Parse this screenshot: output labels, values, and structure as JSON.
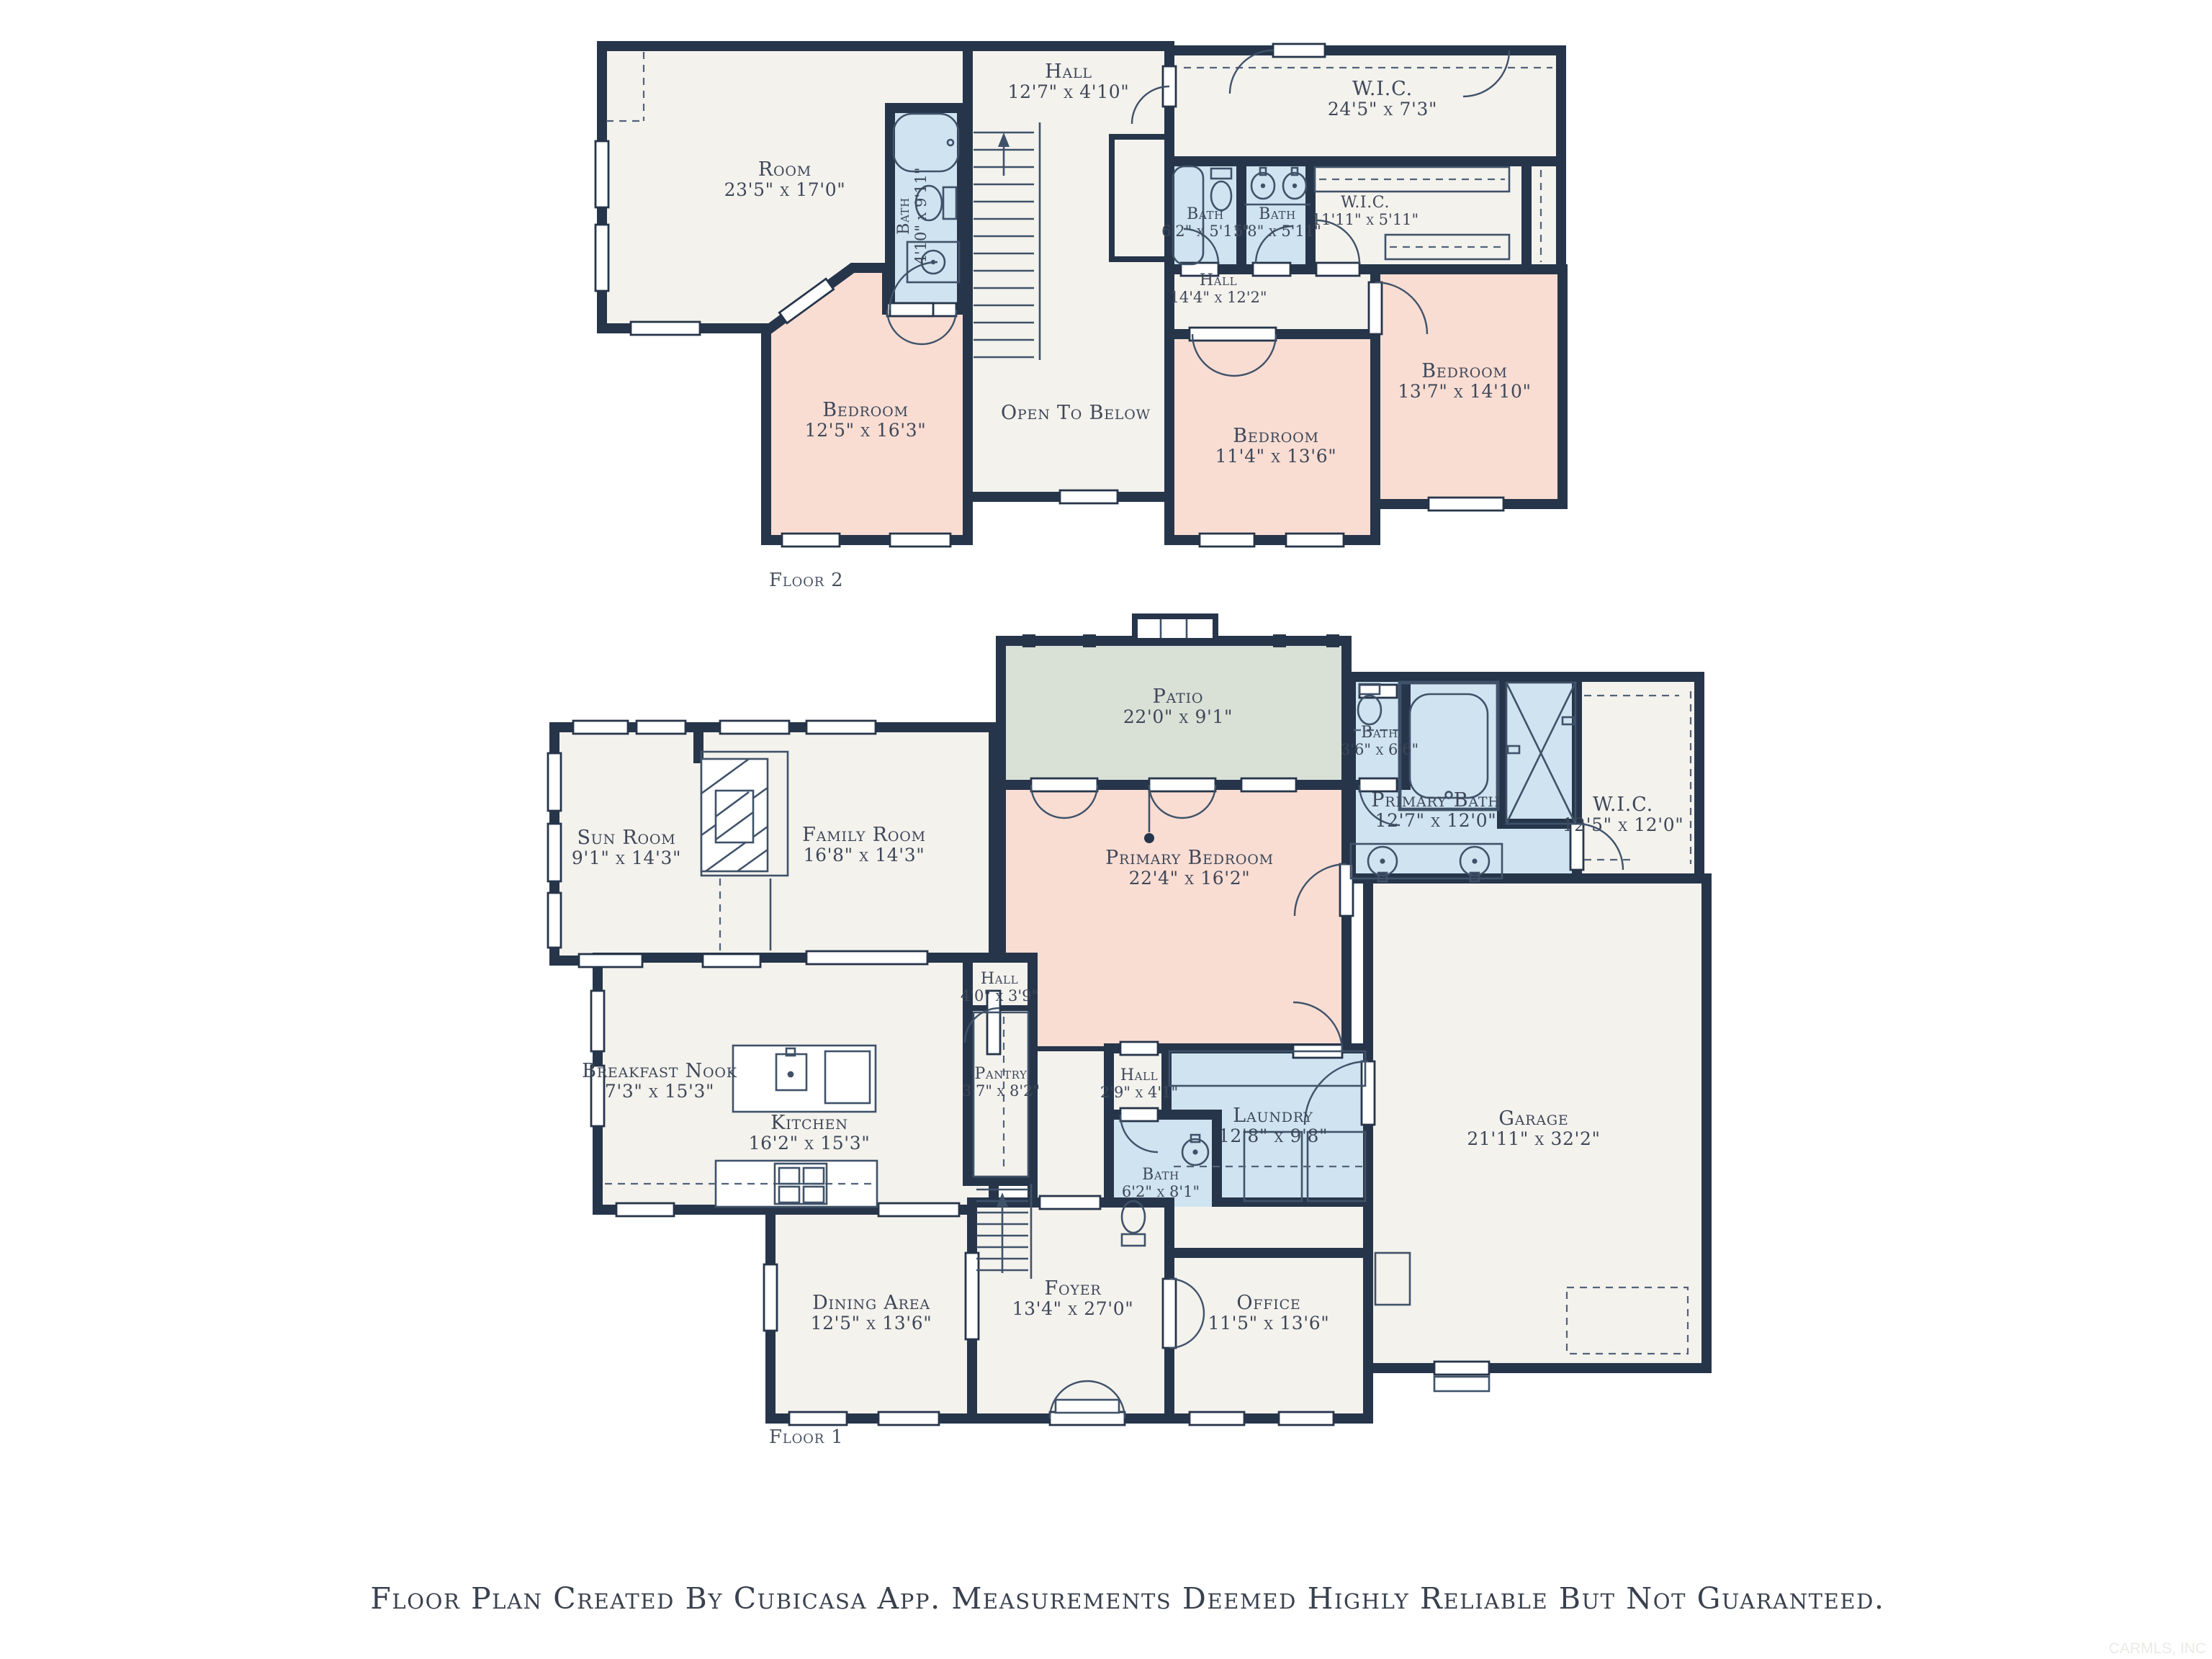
{
  "footer": "Floor Plan Created By Cubicasa App. Measurements Deemed Highly Reliable But Not Guaranteed.",
  "watermark": "CARMLS, INC",
  "colors": {
    "wall": "#26354a",
    "room_fill": "#f4f2ed",
    "bedroom_fill": "#f9ddd3",
    "bath_fill": "#cfe4f0",
    "patio_fill": "#d9e0d6",
    "label_text": "#3e4758",
    "background": "#ffffff"
  },
  "floor2": {
    "label": "Floor 2",
    "rooms": {
      "room": {
        "name": "Room",
        "dims": "23'5\" x 17'0\""
      },
      "hall_top": {
        "name": "Hall",
        "dims": "12'7\" x 4'10\""
      },
      "wic_large": {
        "name": "W.I.C.",
        "dims": "24'5\" x 7'3\""
      },
      "bath_stairs": {
        "name": "Bath",
        "dims": "4'10\" x 9'11\""
      },
      "bath_left": {
        "name": "Bath",
        "dims": "6'2\" x 5'11\""
      },
      "bath_right": {
        "name": "Bath",
        "dims": "5'8\" x 5'11\""
      },
      "wic_small": {
        "name": "W.I.C.",
        "dims": "11'11\" x 5'11\""
      },
      "hall_center": {
        "name": "Hall",
        "dims": "14'4\" x 12'2\""
      },
      "bedroom_left": {
        "name": "Bedroom",
        "dims": "12'5\" x 16'3\""
      },
      "open_to_below": {
        "name": "Open To Below"
      },
      "bedroom_middle": {
        "name": "Bedroom",
        "dims": "11'4\" x 13'6\""
      },
      "bedroom_right": {
        "name": "Bedroom",
        "dims": "13'7\" x 14'10\""
      }
    }
  },
  "floor1": {
    "label": "Floor 1",
    "rooms": {
      "patio": {
        "name": "Patio",
        "dims": "22'0\" x 9'1\""
      },
      "bath_small": {
        "name": "Bath",
        "dims": "3'6\" x 6'6\""
      },
      "primary_bath": {
        "name": "Primary Bath",
        "dims": "12'7\" x 12'0\""
      },
      "wic": {
        "name": "W.I.C.",
        "dims": "12'5\" x 12'0\""
      },
      "sun_room": {
        "name": "Sun Room",
        "dims": "9'1\" x 14'3\""
      },
      "family_room": {
        "name": "Family Room",
        "dims": "16'8\" x 14'3\""
      },
      "primary_bedroom": {
        "name": "Primary Bedroom",
        "dims": "22'4\" x 16'2\""
      },
      "hall_upper": {
        "name": "Hall",
        "dims": "4'0\" x 3'9\""
      },
      "breakfast_nook": {
        "name": "Breakfast Nook",
        "dims": "7'3\" x 15'3\""
      },
      "kitchen": {
        "name": "Kitchen",
        "dims": "16'2\" x 15'3\""
      },
      "pantry": {
        "name": "Pantry",
        "dims": "3'7\" x 8'2\""
      },
      "hall_lower": {
        "name": "Hall",
        "dims": "2'9\" x 4'1\""
      },
      "laundry": {
        "name": "Laundry",
        "dims": "12'8\" x 9'8\""
      },
      "bath_lower": {
        "name": "Bath",
        "dims": "6'2\" x 8'1\""
      },
      "garage": {
        "name": "Garage",
        "dims": "21'11\" x 32'2\""
      },
      "dining_area": {
        "name": "Dining Area",
        "dims": "12'5\" x 13'6\""
      },
      "foyer": {
        "name": "Foyer",
        "dims": "13'4\" x 27'0\""
      },
      "office": {
        "name": "Office",
        "dims": "11'5\" x 13'6\""
      }
    }
  }
}
